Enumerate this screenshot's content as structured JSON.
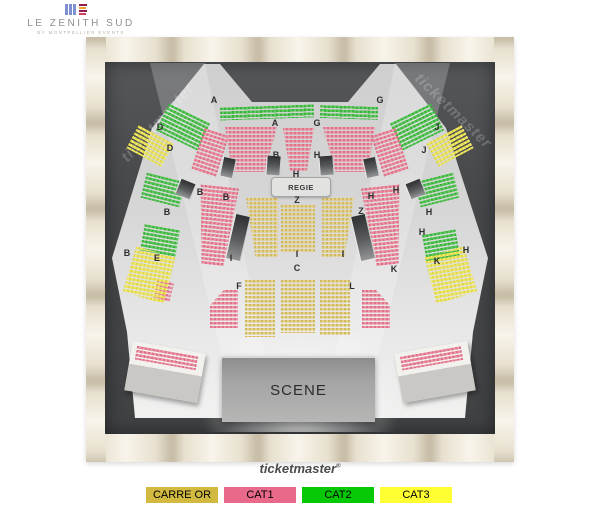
{
  "brand": {
    "title": "LE ZENITH SUD",
    "subtitle": "BY MONTPELLIER EVENTS"
  },
  "watermarks": {
    "left": "ticketmaster",
    "right": "ticketmaster"
  },
  "footer": {
    "brand": "ticketmaster",
    "reg": "®"
  },
  "map": {
    "regie_label": "REGIE",
    "scene_label": "SCENE",
    "labels": [
      {
        "t": "A",
        "x": 214,
        "y": 100
      },
      {
        "t": "G",
        "x": 380,
        "y": 100
      },
      {
        "t": "D",
        "x": 160,
        "y": 127
      },
      {
        "t": "J",
        "x": 437,
        "y": 127
      },
      {
        "t": "D",
        "x": 170,
        "y": 148
      },
      {
        "t": "J",
        "x": 424,
        "y": 150
      },
      {
        "t": "A",
        "x": 275,
        "y": 123
      },
      {
        "t": "G",
        "x": 317,
        "y": 123
      },
      {
        "t": "B",
        "x": 276,
        "y": 155
      },
      {
        "t": "H",
        "x": 317,
        "y": 155
      },
      {
        "t": "H",
        "x": 296,
        "y": 174
      },
      {
        "t": "Z",
        "x": 297,
        "y": 200
      },
      {
        "t": "B",
        "x": 200,
        "y": 192
      },
      {
        "t": "H",
        "x": 396,
        "y": 190
      },
      {
        "t": "B",
        "x": 226,
        "y": 197
      },
      {
        "t": "H",
        "x": 371,
        "y": 196
      },
      {
        "t": "B",
        "x": 167,
        "y": 212
      },
      {
        "t": "H",
        "x": 429,
        "y": 212
      },
      {
        "t": "Z",
        "x": 361,
        "y": 211
      },
      {
        "t": "H",
        "x": 422,
        "y": 232
      },
      {
        "t": "B",
        "x": 127,
        "y": 253
      },
      {
        "t": "H",
        "x": 466,
        "y": 250
      },
      {
        "t": "E",
        "x": 157,
        "y": 258
      },
      {
        "t": "K",
        "x": 437,
        "y": 261
      },
      {
        "t": "I",
        "x": 231,
        "y": 258
      },
      {
        "t": "I",
        "x": 297,
        "y": 254
      },
      {
        "t": "I",
        "x": 343,
        "y": 254
      },
      {
        "t": "K",
        "x": 394,
        "y": 269
      },
      {
        "t": "C",
        "x": 297,
        "y": 268
      },
      {
        "t": "F",
        "x": 239,
        "y": 286
      },
      {
        "t": "L",
        "x": 352,
        "y": 286
      }
    ]
  },
  "legend": {
    "items": [
      {
        "label": "CARRE OR",
        "color": "#d2ba41"
      },
      {
        "label": "CAT1",
        "color": "#e9698a"
      },
      {
        "label": "CAT2",
        "color": "#07c807"
      },
      {
        "label": "CAT3",
        "color": "#ffff32"
      }
    ]
  },
  "category_seat_colors": {
    "carre_or": "#e5d38b",
    "cat1": "#ec95a5",
    "cat2": "#5ec95e",
    "cat3": "#f0e96e"
  }
}
